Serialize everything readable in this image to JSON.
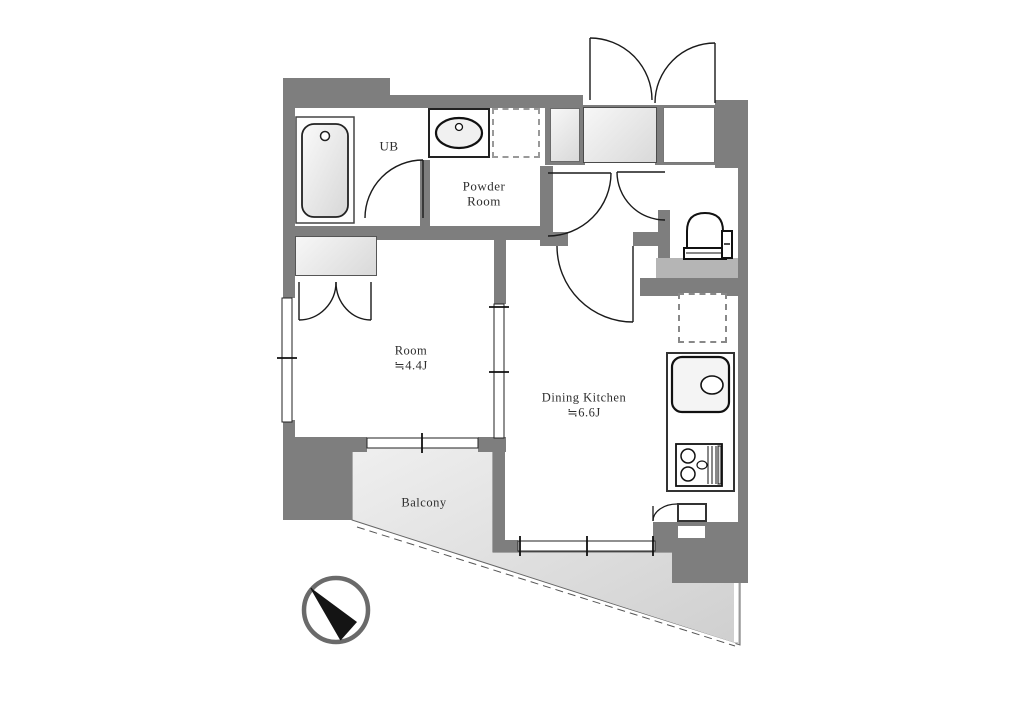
{
  "floorplan": {
    "units": {
      "ub": {
        "label": "UB"
      },
      "powder_room": {
        "line1": "Powder",
        "line2": "Room"
      },
      "washer": {
        "label": "W"
      },
      "shoe_box": {
        "label": "SB"
      },
      "entrance": {
        "label": "Ent."
      },
      "meter_box": {
        "label": "MB"
      },
      "closet_room": {
        "label": "CL"
      },
      "room": {
        "name": "Room",
        "area": "≒4.4J"
      },
      "dining_kitchen": {
        "name": "Dining Kitchen",
        "area": "≒6.6J"
      },
      "upper_shelf": {
        "label": "上部棚"
      },
      "refrigerator": {
        "label": "R"
      },
      "closet_kitchen": {
        "label": "CL"
      },
      "balcony": {
        "label": "Balcony"
      }
    },
    "colors": {
      "wall": "#7e7e7e",
      "balcony_fill": "#dcdcdc",
      "box_fill_light": "#e6e6e6",
      "shelf_band": "#b5b5b5",
      "line": "#1a1a1a"
    }
  }
}
